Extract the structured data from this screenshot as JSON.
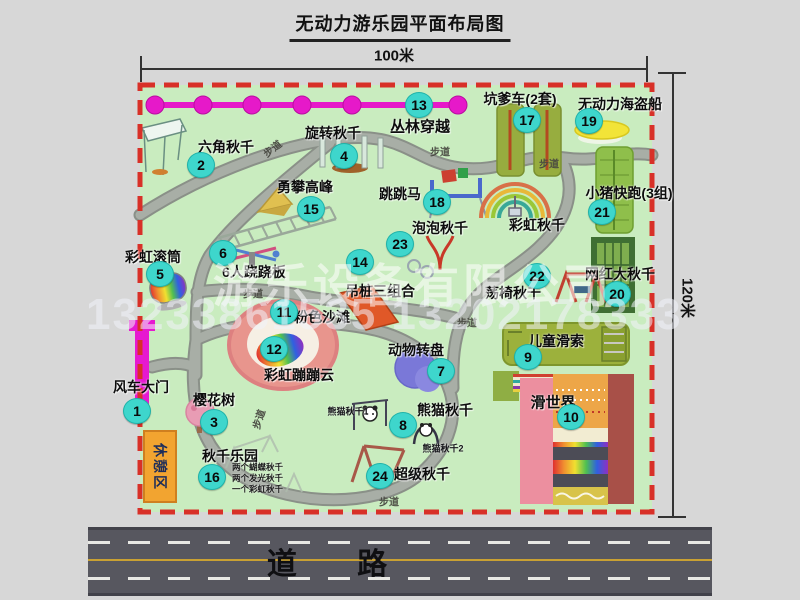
{
  "title": "无动力游乐园平面布局图",
  "dimensions": {
    "width": "100米",
    "height": "120米"
  },
  "road_label": "道 路",
  "path_label": "步道",
  "watermark": {
    "company": "游乐设备有限公司",
    "phone": "13233861535 13202178333"
  },
  "labels": {
    "rainbow_swing": "彩虹秋千",
    "rest_area": "休憩区",
    "panda_swing_1": "熊猫秋千1",
    "panda_swing_2": "熊猫秋千2"
  },
  "attractions": {
    "a1": {
      "num": "1",
      "name": "风车大门"
    },
    "a2": {
      "num": "2",
      "name": "六角秋千"
    },
    "a3": {
      "num": "3",
      "name": "樱花树"
    },
    "a4": {
      "num": "4",
      "name": "旋转秋千"
    },
    "a5": {
      "num": "5",
      "name": "彩虹滚筒"
    },
    "a6": {
      "num": "6",
      "name": "6人跷跷板"
    },
    "a7": {
      "num": "7",
      "name": "动物转盘"
    },
    "a8": {
      "num": "8",
      "name": "熊猫秋千"
    },
    "a9": {
      "num": "9",
      "name": "儿童滑索"
    },
    "a10": {
      "num": "10",
      "name": "滑世界"
    },
    "a11": {
      "num": "11",
      "name": "粉色沙滩"
    },
    "a12": {
      "num": "12",
      "name": "彩虹蹦蹦云"
    },
    "a13": {
      "num": "13",
      "name": "丛林穿越"
    },
    "a14": {
      "num": "14",
      "name": "吊桩三组合"
    },
    "a15": {
      "num": "15",
      "name": "勇攀高峰"
    },
    "a16": {
      "num": "16",
      "name": "秋千乐园",
      "details": [
        "两个蝴蝶秋千",
        "两个发光秋千",
        "一个彩虹秋千"
      ]
    },
    "a17": {
      "num": "17",
      "name": "坑爹车(2套)"
    },
    "a18": {
      "num": "18",
      "name": "跳跳马"
    },
    "a19": {
      "num": "19",
      "name": "无动力海盗船"
    },
    "a20": {
      "num": "20",
      "name": "网红大秋千"
    },
    "a21": {
      "num": "21",
      "name": "小猪快跑(3组)"
    },
    "a22": {
      "num": "22",
      "name": "荡椅秋千"
    },
    "a23": {
      "num": "23",
      "name": "泡泡秋千"
    },
    "a24": {
      "num": "24",
      "name": "超级秋千"
    }
  },
  "colors": {
    "badge": "#3ed6cc",
    "map-green": "#c9ecbf",
    "border-red": "#d83028",
    "chain-magenta": "#e619c9",
    "gate-magenta": "#e619d0",
    "rest-orange": "#f2a430",
    "road-gray": "#57575f",
    "road-yellow": "#c9a133",
    "page-bg": "#d7d7d7"
  }
}
